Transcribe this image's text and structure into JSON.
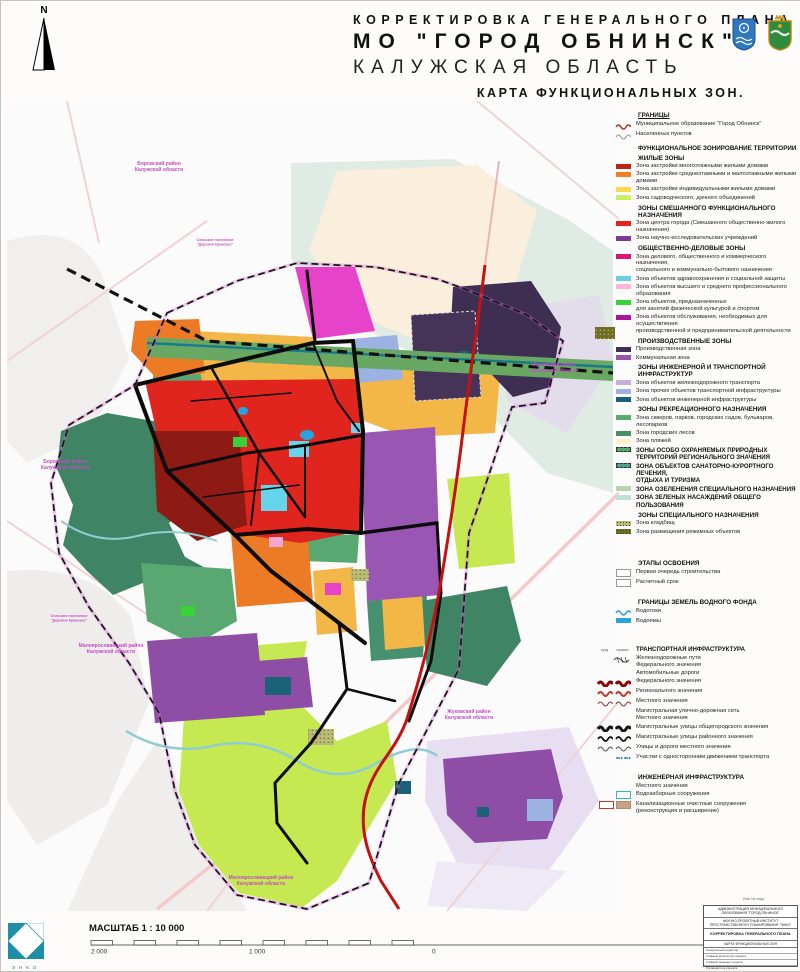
{
  "title": {
    "line1": "КОРРЕКТИРОВКА  ГЕНЕРАЛЬНОГО  ПЛАНА",
    "line2": "МО \"ГОРОД ОБНИНСК\"",
    "line3": "КАЛУЖСКАЯ ОБЛАСТЬ",
    "line4": "КАРТА  ФУНКЦИОНАЛЬНЫХ  ЗОН."
  },
  "north": {
    "label": "N"
  },
  "colors": {
    "accent_magenta": "#c24ec2",
    "federal_road_red": "#c41212",
    "water_blue": "#29a3e0",
    "rail_band_green": "#69a862"
  },
  "legend": {
    "rows": [
      {
        "t": "h",
        "u": true,
        "label": "ГРАНИЦЫ"
      },
      {
        "t": "line",
        "c": "#b03030",
        "w": 1.5,
        "label": "Муниципальное образование \"Город Обнинск\""
      },
      {
        "t": "line",
        "c": "#999999",
        "w": 1.1,
        "label": "Населенных пунктов"
      },
      {
        "t": "h",
        "label": "ФУНКЦИОНАЛЬНОЕ ЗОНИРОВАНИЕ ТЕРРИТОРИИ"
      },
      {
        "t": "sh",
        "label": "ЖИЛЫЕ ЗОНЫ"
      },
      {
        "t": "sw",
        "c": "#bb2317",
        "label": "Зона застройки многоэтажными жилыми домами"
      },
      {
        "t": "sw",
        "c": "#f07f1f",
        "label": "Зона застройки среднеэтажными и малоэтажными жилыми домами"
      },
      {
        "t": "sw",
        "c": "#ffd94d",
        "label": "Зона застройки индивидуальными жилыми домами"
      },
      {
        "t": "sw",
        "c": "#c9ef63",
        "label": "Зона садоводческого, дачного объединений"
      },
      {
        "t": "sh",
        "label": "ЗОНЫ СМЕШАННОГО ФУНКЦИОНАЛЬНОГО НАЗНАЧЕНИЯ"
      },
      {
        "t": "sw",
        "c": "#e3241f",
        "label": "Зона центра города (Смешанного общественно-жилого назначения)"
      },
      {
        "t": "sw",
        "c": "#7d3a96",
        "label": "Зона научно-исследовательских учреждений"
      },
      {
        "t": "sh",
        "label": "ОБЩЕСТВЕННО-ДЕЛОВЫЕ ЗОНЫ"
      },
      {
        "t": "sw",
        "c": "#d81874",
        "label": "Зона делового, общественного и коммерческого назначения,",
        "label2": "социального и коммунально-бытового назначения"
      },
      {
        "t": "sw",
        "c": "#66d0e4",
        "label": "Зона объектов здравоохранения и социальной защиты"
      },
      {
        "t": "sw",
        "c": "#f8b6d8",
        "label": "Зона объектов высшего и среднего профессионального образования"
      },
      {
        "t": "sw",
        "c": "#38d337",
        "label": "Зона объектов, предназначенных",
        "label2": "для занятий физической культурой и спортом"
      },
      {
        "t": "sw",
        "c": "#a9189b",
        "label": "Зона объектов обслуживания, необходимых для осуществления",
        "label2": "производственной и предпринимательской деятельности"
      },
      {
        "t": "sh",
        "label": "ПРОИЗВОДСТВЕННЫЕ ЗОНЫ"
      },
      {
        "t": "sw",
        "c": "#413055",
        "label": "Производственная зона"
      },
      {
        "t": "sw",
        "c": "#9357ad",
        "label": "Коммунальная зона"
      },
      {
        "t": "sh",
        "label": "ЗОНЫ ИНЖЕНЕРНОЙ И ТРАНСПОРТНОЙ ИНФРАСТРУКТУР"
      },
      {
        "t": "sw",
        "c": "#c7aedd",
        "label": "Зона объектов железнодорожного транспорта"
      },
      {
        "t": "sw",
        "c": "#9fb1de",
        "label": "Зона прочих объектов транспортной инфраструктуры"
      },
      {
        "t": "sw",
        "c": "#1c6076",
        "label": "Зона объектов инженерной инфраструктуры"
      },
      {
        "t": "sh",
        "label": "ЗОНЫ РЕКРЕАЦИОННОГО НАЗНАЧЕНИЯ"
      },
      {
        "t": "sw",
        "c": "#5aa96f",
        "label": "Зона скверов, парков, городских садов, бульваров, лесопарков"
      },
      {
        "t": "sw",
        "c": "#4a8f68",
        "label": "Зона городских лесов"
      },
      {
        "t": "sw",
        "c": "#fbf3c6",
        "label": "Зона пляжей"
      },
      {
        "t": "swh",
        "c": "#55a86e",
        "dash": true,
        "label": "ЗОНЫ ОСОБО ОХРАНЯЕМЫХ ПРИРОДНЫХ",
        "label2": "ТЕРРИТОРИЙ РЕГИОНАЛЬНОГО ЗНАЧЕНИЯ"
      },
      {
        "t": "swh",
        "c": "#49a18c",
        "dash": true,
        "label": "ЗОНА ОБЪЕКТОВ САНАТОРНО-КУРОРТНОГО ЛЕЧЕНИЯ,",
        "label2": "ОТДЫХА И ТУРИЗМА"
      },
      {
        "t": "swh",
        "c": "#b7d3ae",
        "label": "ЗОНА ОЗЕЛЕНЕНИЯ СПЕЦИАЛЬНОГО НАЗНАЧЕНИЯ"
      },
      {
        "t": "swh",
        "c": "#bfe0d2",
        "label": "ЗОНА ЗЕЛЕНЫХ НАСАЖДЕНИЙ ОБЩЕГО ПОЛЬЗОВАНИЯ"
      },
      {
        "t": "sh",
        "label": "ЗОНЫ СПЕЦИАЛЬНОГО НАЗНАЧЕНИЯ"
      },
      {
        "t": "sw",
        "c": "#b9bc72",
        "dots": true,
        "label": "Зона кладбищ"
      },
      {
        "t": "sw",
        "c": "#6f6e22",
        "dots": true,
        "label": "Зона размещения режимных объектов"
      },
      {
        "t": "gap",
        "h": 18
      },
      {
        "t": "h",
        "label": "ЭТАПЫ ОСВОЕНИЯ"
      },
      {
        "t": "box",
        "c": "#ffffff",
        "b": "#999999",
        "label": "Первая очередь строительства"
      },
      {
        "t": "box",
        "c": "#ffffff",
        "b": "#999999",
        "label": "Расчетный срок"
      },
      {
        "t": "gap",
        "h": 5
      },
      {
        "t": "h",
        "label": "ГРАНИЦЫ ЗЕМЕЛЬ ВОДНОГО ФОНДА"
      },
      {
        "t": "line",
        "c": "#2a9fd8",
        "w": 1.5,
        "label": "Водотоки"
      },
      {
        "t": "sw",
        "c": "#29a3e0",
        "label": "Водоемы"
      },
      {
        "t": "gap",
        "h": 20
      },
      {
        "t": "h2",
        "cols": [
          "сущ.",
          "проект."
        ],
        "label": "ТРАНСПОРТНАЯ ИНФРАСТРУКТУРА"
      },
      {
        "t": "plain",
        "rail": true,
        "label": "Железнодорожные пути",
        "label2": "Федерального значения"
      },
      {
        "t": "plain",
        "label": "Автомобильные дороги"
      },
      {
        "t": "zig2",
        "c": "#8b0000",
        "w": 3,
        "label": "Федерального значения"
      },
      {
        "t": "zig2",
        "c": "#c0392b",
        "w": 2,
        "label": "Регионального значения"
      },
      {
        "t": "zig2",
        "c": "#8b3a3a",
        "w": 1.1,
        "label": "Местного значения"
      },
      {
        "t": "plain",
        "label": "Магистральная улично-дорожная сеть",
        "label2": "Местного значения"
      },
      {
        "t": "zig2",
        "c": "#111111",
        "w": 3,
        "label": "Магистральные улицы общегородского значения"
      },
      {
        "t": "zig2",
        "c": "#111111",
        "w": 1.7,
        "label": "Магистральные улицы районного значения"
      },
      {
        "t": "zig2",
        "c": "#555555",
        "w": 1,
        "label": "Улицы и дороги местного значения"
      },
      {
        "t": "arrow",
        "c": "#2a7fd4",
        "label": "Участки с односторонним движением транспорта"
      },
      {
        "t": "gap",
        "h": 5
      },
      {
        "t": "h",
        "label": "ИНЖЕНЕРНАЯ ИНФРАСТРУКТУРА"
      },
      {
        "t": "plain",
        "label": "Местного значения"
      },
      {
        "t": "box",
        "c": "#f2fcff",
        "b": "#3ab0d0",
        "label": "Водозаборные сооружения"
      },
      {
        "t": "box2",
        "c1": "#ffffff",
        "b1": "#c0392b",
        "c2": "#c9a489",
        "b2": "#b08968",
        "label": "Канализационные очистные сооружения",
        "label2": "(реконструкция и расширение)"
      }
    ]
  },
  "map": {
    "labels": [
      {
        "x": 152,
        "y": 64,
        "s": 5,
        "l": [
          "Боровский район",
          "Калужской области"
        ]
      },
      {
        "x": 58,
        "y": 362,
        "s": 5,
        "l": [
          "Боровский район",
          "Калужской области"
        ]
      },
      {
        "x": 547,
        "y": 265,
        "s": 5,
        "l": [
          "Жуковский район",
          "Калужской области"
        ]
      },
      {
        "x": 462,
        "y": 612,
        "s": 5,
        "l": [
          "Жуковский район",
          "Калужской области"
        ]
      },
      {
        "x": 104,
        "y": 546,
        "s": 5,
        "l": [
          "Малоярославецкий район",
          "Калужской области"
        ]
      },
      {
        "x": 254,
        "y": 778,
        "s": 5,
        "l": [
          "Малоярославецкий район",
          "Калужской области"
        ]
      },
      {
        "x": 208,
        "y": 140,
        "s": 3.6,
        "l": [
          "Сельское поселение",
          "\"Деревня Кривское\""
        ]
      },
      {
        "x": 62,
        "y": 516,
        "s": 3.6,
        "l": [
          "Сельское поселение",
          "\"Деревня Кривское\""
        ]
      }
    ]
  },
  "scale": {
    "label": "МАСШТАБ 1 : 10 000",
    "t2000a": "2 000",
    "t1000": "1 000",
    "t0": "0",
    "t2000b": "2 000",
    "unit": "МЕТРЫ"
  },
  "logo": {
    "text": "ЭНКО"
  },
  "stamp": {
    "inv": "Инв. № подл.",
    "org1": "АДМИНИСТРАЦИЯ МУНИЦИПАЛЬНОГО ОБРАЗОВАНИЯ \"ГОРОД ОБНИНСК\"",
    "org2": "НАУЧНО-ПРОЕКТНЫЙ ИНСТИТУТ ПРОСТРАНСТВЕННОГО ПЛАНИРОВАНИЯ \"ЭНКО\"",
    "proj": "КОРРЕКТИРОВКА ГЕНЕРАЛЬНОГО ПЛАНА",
    "sheet": "КАРТА ФУНКЦИОНАЛЬНЫХ ЗОН",
    "roles": [
      "Генеральный директор",
      "Главный архитектор проекта",
      "Главный инженер проекта",
      "Руководитель проекта",
      "Начальник отдела"
    ],
    "city": "Санкт-Петербург"
  }
}
